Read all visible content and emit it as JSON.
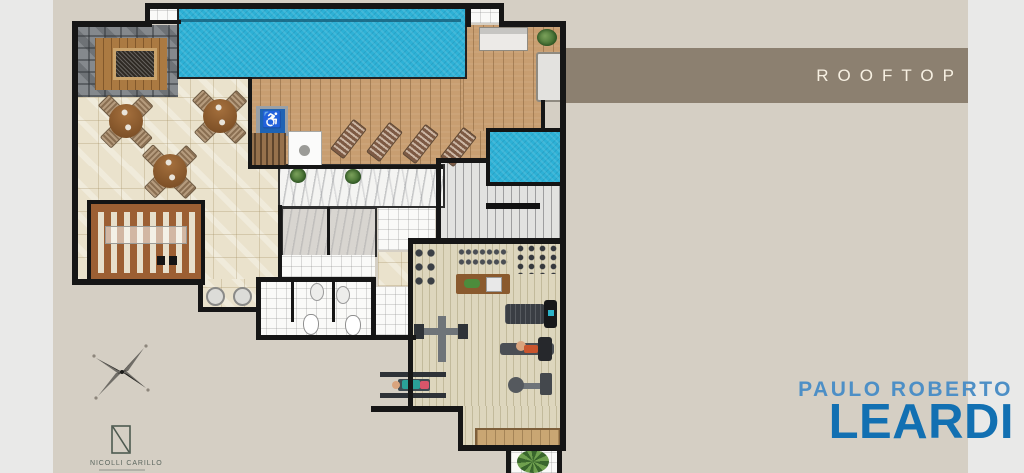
{
  "slide": {
    "header": {
      "title": "ROOFTOP",
      "band_color": "#8c8070",
      "text_color": "#f7f0e2"
    },
    "background": {
      "card_color": "#d5cfc4",
      "margin_color": "#e9e9e8"
    },
    "brand": {
      "top_line": "PAULO ROBERTO",
      "name": "LEARDI",
      "top_color": "#4d8fc6",
      "name_color": "#1270b2"
    },
    "architect": {
      "name": "NICOLLI CARILLO",
      "logo": "n-square-monogram",
      "color": "#5b665e"
    }
  },
  "floorplan": {
    "icons": {
      "wheelchair": "♿",
      "compass": "four-point-star"
    },
    "areas": [
      "main-pool",
      "spa-pool",
      "wood-deck",
      "fire-pit-lounge",
      "dining-patio",
      "pergola-grill-area",
      "restroom-block",
      "elevator-core",
      "staircase",
      "gym",
      "planter-bench",
      "palm-planter",
      "accessible-pool-lift"
    ],
    "colors": {
      "pool": "#2db1d6",
      "deck": "#c89e71",
      "patio": "#eae2cc",
      "stone_pavers": "#85898d",
      "gym_floor": "#ddd6bd",
      "wall": "#161616",
      "accessible_sign_blue": "#1e63b4"
    }
  }
}
